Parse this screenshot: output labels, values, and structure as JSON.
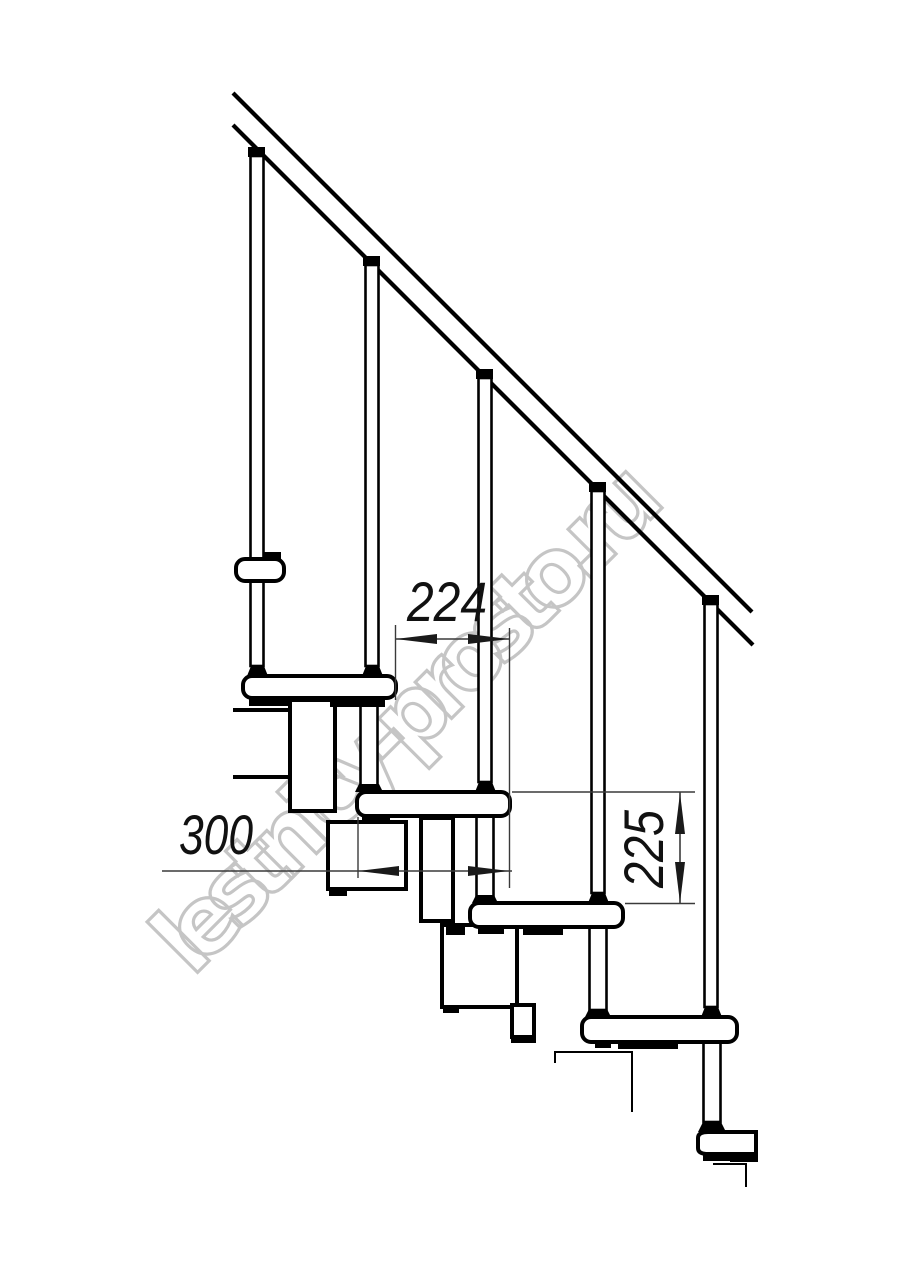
{
  "drawing": {
    "watermark": {
      "text": "lestnicy-prosto.ru",
      "color": "#c5c5c5",
      "angle_deg": -45
    },
    "dimensions": [
      {
        "id": "step-run",
        "value": "224",
        "orientation": "horizontal"
      },
      {
        "id": "tread-depth",
        "value": "300",
        "orientation": "horizontal"
      },
      {
        "id": "step-rise",
        "value": "225",
        "orientation": "vertical"
      }
    ],
    "colors": {
      "line": "#000000",
      "dim_line": "#3a3a3a",
      "background": "#ffffff"
    }
  }
}
